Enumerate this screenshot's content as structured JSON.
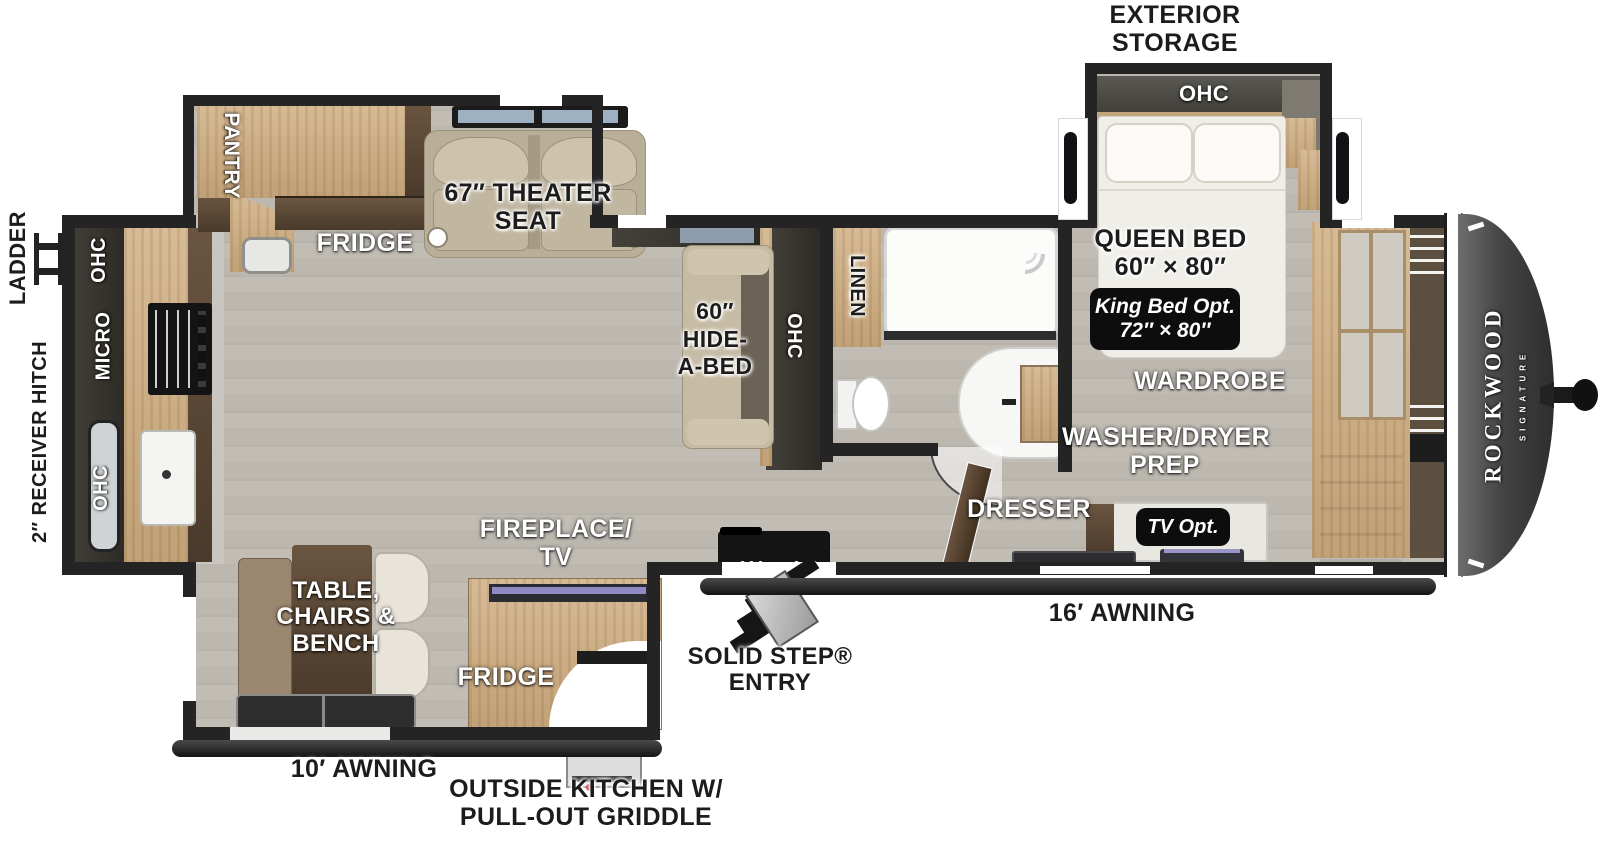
{
  "brand": {
    "name": "ROCKWOOD",
    "tagline": "SIGNATURE"
  },
  "exterior": {
    "storage": "EXTERIOR\nSTORAGE",
    "ladder": "LADDER",
    "receiver_hitch": "2″ RECEIVER HITCH",
    "awning16": "16′ AWNING",
    "awning10": "10′ AWNING",
    "solid_step": "SOLID STEP®\nENTRY",
    "outside_kitchen": "OUTSIDE KITCHEN W/\nPULL-OUT GRIDDLE"
  },
  "bedroom": {
    "ohc": "OHC",
    "queen": "QUEEN BED\n60″ × 80″",
    "king_opt": "King Bed Opt.\n72″ × 80″",
    "wardrobe": "WARDROBE",
    "washer_dryer": "WASHER/DRYER\nPREP",
    "dresser": "DRESSER",
    "tv_opt": "TV Opt."
  },
  "bathroom": {
    "linen": "LINEN"
  },
  "living": {
    "theater": "67″ THEATER\nSEAT",
    "hide_a_bed": "60″\nHIDE-\nA-BED",
    "ohc": "OHC",
    "fridge": "FRIDGE",
    "pantry": "PANTRY",
    "fireplace_tv": "FIREPLACE/\nTV",
    "dinette": "TABLE,\nCHAIRS &\nBENCH",
    "outside_fridge": "FRIDGE"
  },
  "kitchen": {
    "ohc_upper": "OHC",
    "micro": "MICRO",
    "ohc_lower": "OHC"
  }
}
